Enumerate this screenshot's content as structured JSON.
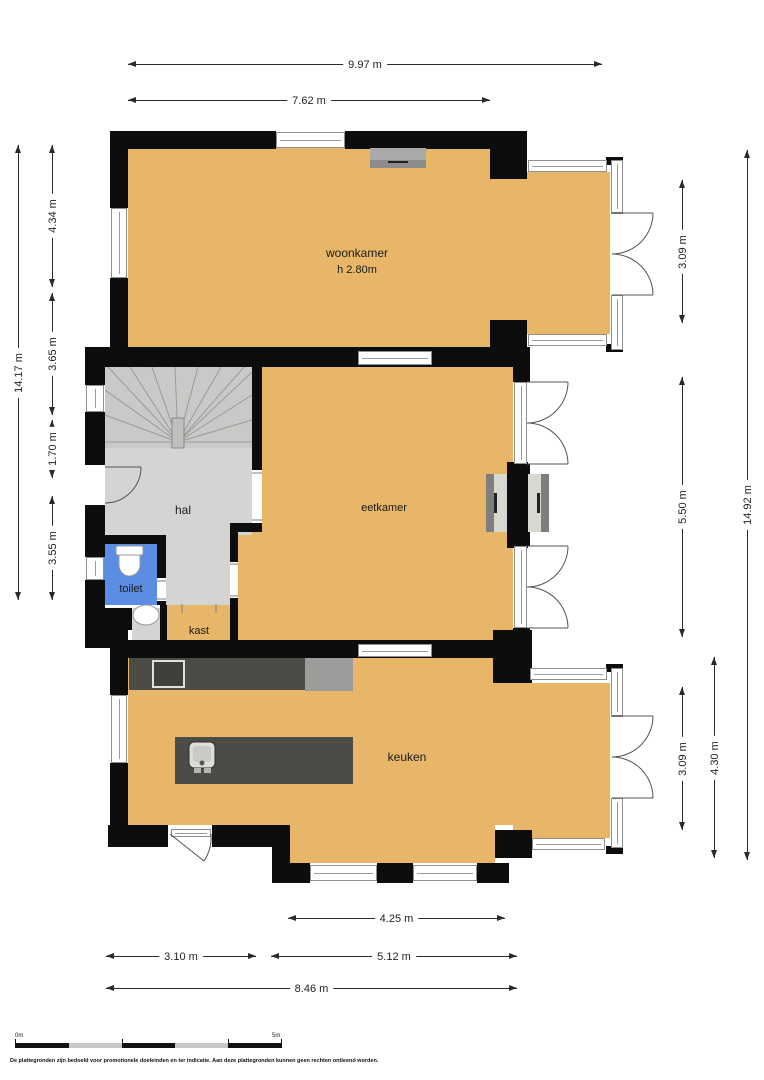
{
  "rooms": {
    "woonkamer": {
      "label": "woonkamer",
      "height": "h 2.80m"
    },
    "eetkamer": {
      "label": "eetkamer"
    },
    "hal": {
      "label": "hal"
    },
    "toilet": {
      "label": "toilet"
    },
    "kast": {
      "label": "kast"
    },
    "keuken": {
      "label": "keuken"
    }
  },
  "dims": {
    "top_total": "9.97 m",
    "top_woonkamer": "7.62 m",
    "left_total": "14.17 m",
    "left_woonkamer": "4.34 m",
    "left_hal": "3.65 m",
    "left_toilet": "1.70 m",
    "left_keuken": "3.55 m",
    "right_woonkamer": "3.09 m",
    "right_eetkamer": "5.50 m",
    "right_keuken": "3.09 m",
    "right_keuken_total": "4.30 m",
    "right_total": "14.92 m",
    "bottom_keuken": "4.25 m",
    "bottom_left": "3.10 m",
    "bottom_mid": "5.12 m",
    "bottom_total": "8.46 m"
  },
  "scale": {
    "start": "0m",
    "end": "5m"
  },
  "disclaimer": "De plattegronden zijn bedoeld voor promotionele doeleinden en ter indicatie. Aan deze plattegronden kunnen geen rechten ontleend worden.",
  "colors": {
    "floor": "#E8B668",
    "hall_floor": "#D4D4D2",
    "stairs": "#C9C9C7",
    "toilet": "#5B8EE3",
    "wall": "#0D0D0D",
    "counter": "#4B4B47"
  }
}
